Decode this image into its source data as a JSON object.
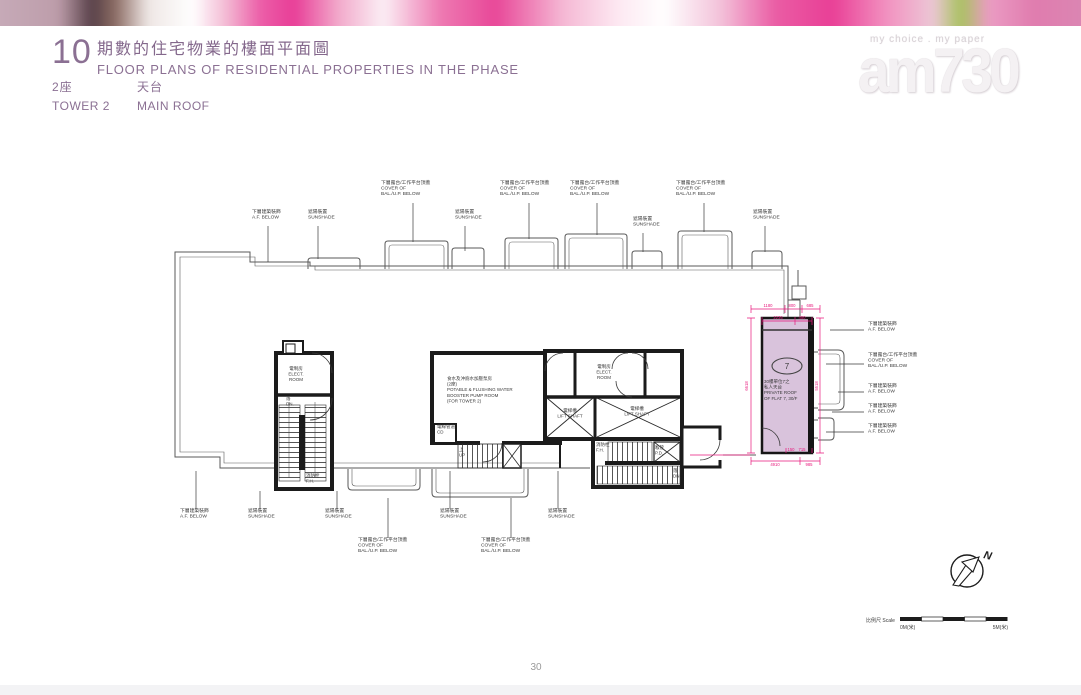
{
  "header": {
    "section_number": "10",
    "title_zh": "期數的住宅物業的樓面平面圖",
    "title_en": "FLOOR PLANS OF RESIDENTIAL PROPERTIES IN THE PHASE",
    "tower_zh": "2座",
    "tower_en": "TOWER 2",
    "floor_zh": "天台",
    "floor_en": "MAIN ROOF"
  },
  "watermark": {
    "tagline": "my choice . my paper",
    "logo": "am730"
  },
  "footer": {
    "page_number": "30"
  },
  "compass": {
    "north": "N"
  },
  "scale_bar": {
    "label": "比例尺 Scale",
    "start": "0M(米)",
    "end": "5M(米)"
  },
  "label_types": {
    "af": {
      "lines": [
        "下層建築裝飾",
        "A.F. BELOW"
      ]
    },
    "sunshade": {
      "lines": [
        "遮陽裝置",
        "SUNSHADE"
      ]
    },
    "cover": {
      "lines": [
        "下層露台/工作平台頂蓋",
        "COVER OF",
        "BAL./U.P. BELOW"
      ]
    }
  },
  "plan": {
    "callouts": [
      {
        "t": "af",
        "x": 252,
        "y": 213,
        "leader": [
          268,
          226,
          268,
          262
        ]
      },
      {
        "t": "sunshade",
        "x": 308,
        "y": 213,
        "leader": [
          318,
          226,
          318,
          259
        ]
      },
      {
        "t": "cover",
        "x": 381,
        "y": 184,
        "leader": [
          413,
          203,
          413,
          242
        ]
      },
      {
        "t": "sunshade",
        "x": 455,
        "y": 213,
        "leader": [
          465,
          226,
          465,
          251
        ]
      },
      {
        "t": "cover",
        "x": 500,
        "y": 184,
        "leader": [
          529,
          203,
          529,
          239
        ]
      },
      {
        "t": "cover",
        "x": 570,
        "y": 184,
        "leader": [
          597,
          203,
          597,
          235
        ]
      },
      {
        "t": "sunshade",
        "x": 633,
        "y": 220,
        "leader": [
          643,
          233,
          643,
          252
        ]
      },
      {
        "t": "cover",
        "x": 676,
        "y": 184,
        "leader": [
          704,
          203,
          704,
          232
        ]
      },
      {
        "t": "sunshade",
        "x": 753,
        "y": 213,
        "leader": [
          765,
          226,
          765,
          252
        ]
      },
      {
        "t": "af",
        "x": 180,
        "y": 512,
        "leader": [
          196,
          509,
          196,
          471
        ]
      },
      {
        "t": "sunshade",
        "x": 248,
        "y": 512,
        "leader": [
          260,
          509,
          260,
          491
        ]
      },
      {
        "t": "sunshade",
        "x": 325,
        "y": 512,
        "leader": [
          337,
          509,
          337,
          491
        ]
      },
      {
        "t": "cover",
        "x": 358,
        "y": 541,
        "leader": [
          388,
          538,
          388,
          498
        ]
      },
      {
        "t": "sunshade",
        "x": 440,
        "y": 512,
        "leader": [
          450,
          509,
          450,
          471
        ]
      },
      {
        "t": "cover",
        "x": 481,
        "y": 541,
        "leader": [
          511,
          538,
          511,
          498
        ]
      },
      {
        "t": "sunshade",
        "x": 548,
        "y": 512,
        "leader": [
          558,
          509,
          558,
          471
        ]
      },
      {
        "t": "af",
        "x": 868,
        "y": 325,
        "leader": [
          830,
          330,
          864,
          330
        ]
      },
      {
        "t": "cover",
        "x": 868,
        "y": 356,
        "leader": [
          826,
          364,
          864,
          364
        ]
      },
      {
        "t": "af",
        "x": 868,
        "y": 387,
        "leader": [
          838,
          392,
          864,
          392
        ]
      },
      {
        "t": "af",
        "x": 868,
        "y": 407,
        "leader": [
          832,
          412,
          864,
          412
        ]
      },
      {
        "t": "af",
        "x": 868,
        "y": 427,
        "leader": [
          826,
          432,
          864,
          432
        ]
      }
    ],
    "room_labels": [
      {
        "name": "elect-room-left",
        "x": 296,
        "y": 370,
        "anchor": "middle",
        "lines": [
          "電制房",
          "ELECT.",
          "ROOM"
        ]
      },
      {
        "name": "down-left",
        "x": 286,
        "y": 400,
        "anchor": "start",
        "lines": [
          "落",
          "DN."
        ]
      },
      {
        "name": "fire-hydrant-left",
        "x": 306,
        "y": 477,
        "anchor": "start",
        "lines": [
          "消防栓",
          "F.H."
        ]
      },
      {
        "name": "pump-room",
        "x": 447,
        "y": 380,
        "anchor": "start",
        "lines": [
          "食水及沖廁水加壓泵房",
          "(2座)",
          "POTABLE & FLUSHING WATER",
          "BOOSTER PUMP ROOM",
          "(FOR TOWER 2)"
        ]
      },
      {
        "name": "cable-duct",
        "x": 437,
        "y": 428,
        "anchor": "start",
        "lines": [
          "電線管道",
          "CD"
        ]
      },
      {
        "name": "up-center",
        "x": 459,
        "y": 451,
        "anchor": "start",
        "lines": [
          "上",
          "UP"
        ]
      },
      {
        "name": "elect-room-right",
        "x": 604,
        "y": 368,
        "anchor": "middle",
        "lines": [
          "電制房",
          "ELECT.",
          "ROOM"
        ]
      },
      {
        "name": "lift-shaft-1",
        "x": 570,
        "y": 412,
        "anchor": "middle",
        "lines": [
          "電梯槽",
          "LIFT SHAFT"
        ]
      },
      {
        "name": "lift-shaft-2",
        "x": 637,
        "y": 410,
        "anchor": "middle",
        "lines": [
          "電梯槽",
          "LIFT SHAFT"
        ]
      },
      {
        "name": "fire-hydrant-center",
        "x": 596,
        "y": 446,
        "anchor": "start",
        "lines": [
          "消防栓",
          "F.H."
        ]
      },
      {
        "name": "pipe-duct",
        "x": 655,
        "y": 449,
        "anchor": "start",
        "lines": [
          "喉管",
          "P.D."
        ]
      },
      {
        "name": "down-center",
        "x": 673,
        "y": 472,
        "anchor": "start",
        "lines": [
          "落",
          "DN."
        ]
      },
      {
        "name": "flat7-roof-label",
        "x": 764,
        "y": 383,
        "anchor": "start",
        "lines": [
          "30樓單位7之",
          "私人天台",
          "PRIVATE ROOF",
          "OF FLAT 7, 30/F"
        ]
      }
    ],
    "flat7": {
      "number": "7"
    },
    "dim_texts": [
      {
        "x": 768,
        "y": 307,
        "t": "1180"
      },
      {
        "x": 792,
        "y": 307,
        "t": "800"
      },
      {
        "x": 810,
        "y": 307,
        "t": "685"
      },
      {
        "x": 778,
        "y": 319,
        "t": "2235"
      },
      {
        "x": 802,
        "y": 319,
        "t": "450"
      },
      {
        "x": 775,
        "y": 466,
        "t": "4910"
      },
      {
        "x": 809,
        "y": 466,
        "t": "985"
      },
      {
        "x": 791,
        "y": 451,
        "t": "150"
      },
      {
        "x": 802,
        "y": 451,
        "t": "715"
      },
      {
        "x": 748,
        "y": 386,
        "t": "6618",
        "rot": -90
      },
      {
        "x": 818,
        "y": 386,
        "t": "5518",
        "rot": -90
      }
    ]
  }
}
